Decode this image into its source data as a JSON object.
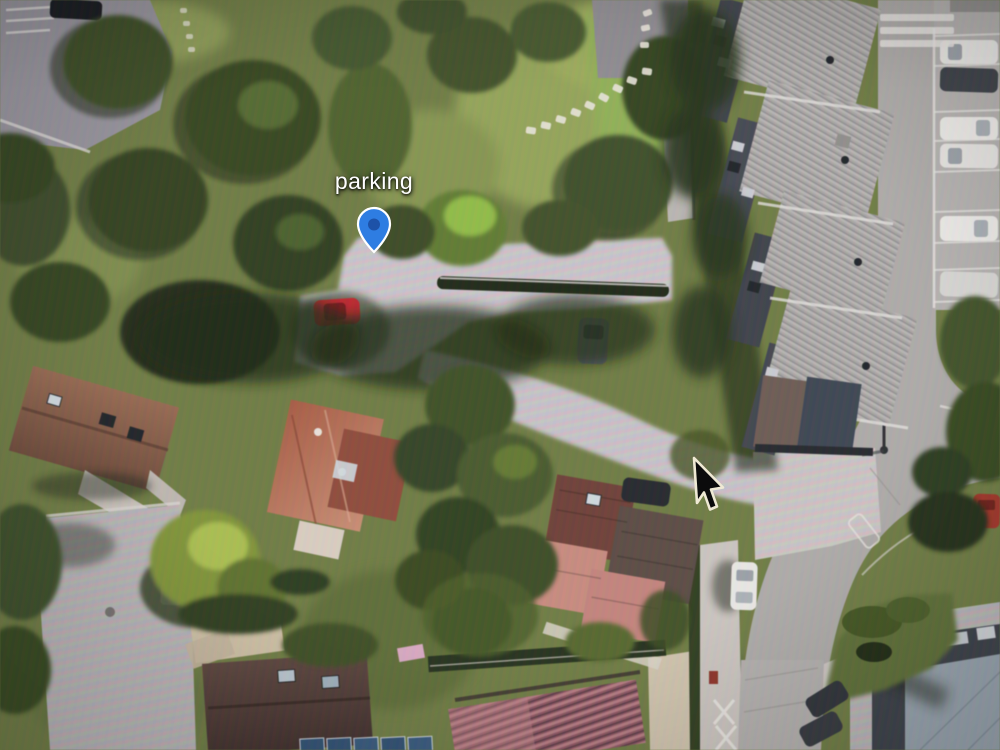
{
  "view": {
    "kind": "satellite-map-photo",
    "label": {
      "text": "parking"
    },
    "pin": {
      "fill": "#2e7de2",
      "inner": "#1d52a8",
      "stroke": "#ffffff"
    },
    "cursor": {
      "fill": "#0b0b0c",
      "stroke": "#efe9d4"
    },
    "palette": {
      "park_grass": "#6e7b40",
      "sunny_grass": "#93a355",
      "tree_dark": "#2c3a1c",
      "pavement_light": "#ccc5c1",
      "road": "#adaaa7",
      "apartment_roof": "#a9a6a3",
      "house_roof_red": "#b06048",
      "house_roof_brown": "#7a5340",
      "house_roof_maroon": "#4a342e",
      "modern_roof": "#97a3ad",
      "car_red": "#c0252c",
      "car_white": "#eceae6",
      "solar_panel": "#2e4f72"
    }
  }
}
